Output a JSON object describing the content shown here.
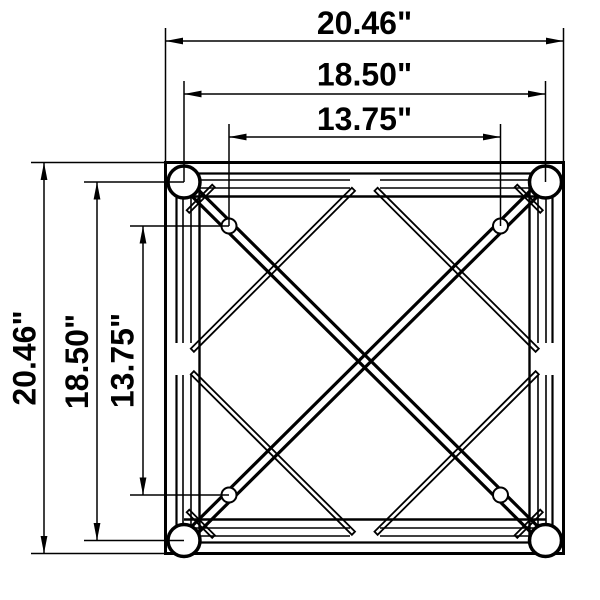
{
  "drawing": {
    "subject": "square-truss-cross-section",
    "colors": {
      "line": "#000000",
      "background": "#ffffff"
    },
    "horizontal_dimensions": [
      {
        "id": "outer-width",
        "label": "20.46\"",
        "value_in": 20.46
      },
      {
        "id": "tube-center-width",
        "label": "18.50\"",
        "value_in": 18.5
      },
      {
        "id": "hole-center-width",
        "label": "13.75\"",
        "value_in": 13.75
      }
    ],
    "vertical_dimensions": [
      {
        "id": "outer-height",
        "label": "20.46\"",
        "value_in": 20.46
      },
      {
        "id": "tube-center-height",
        "label": "18.50\"",
        "value_in": 18.5
      },
      {
        "id": "hole-center-height",
        "label": "13.75\"",
        "value_in": 13.75
      }
    ]
  }
}
